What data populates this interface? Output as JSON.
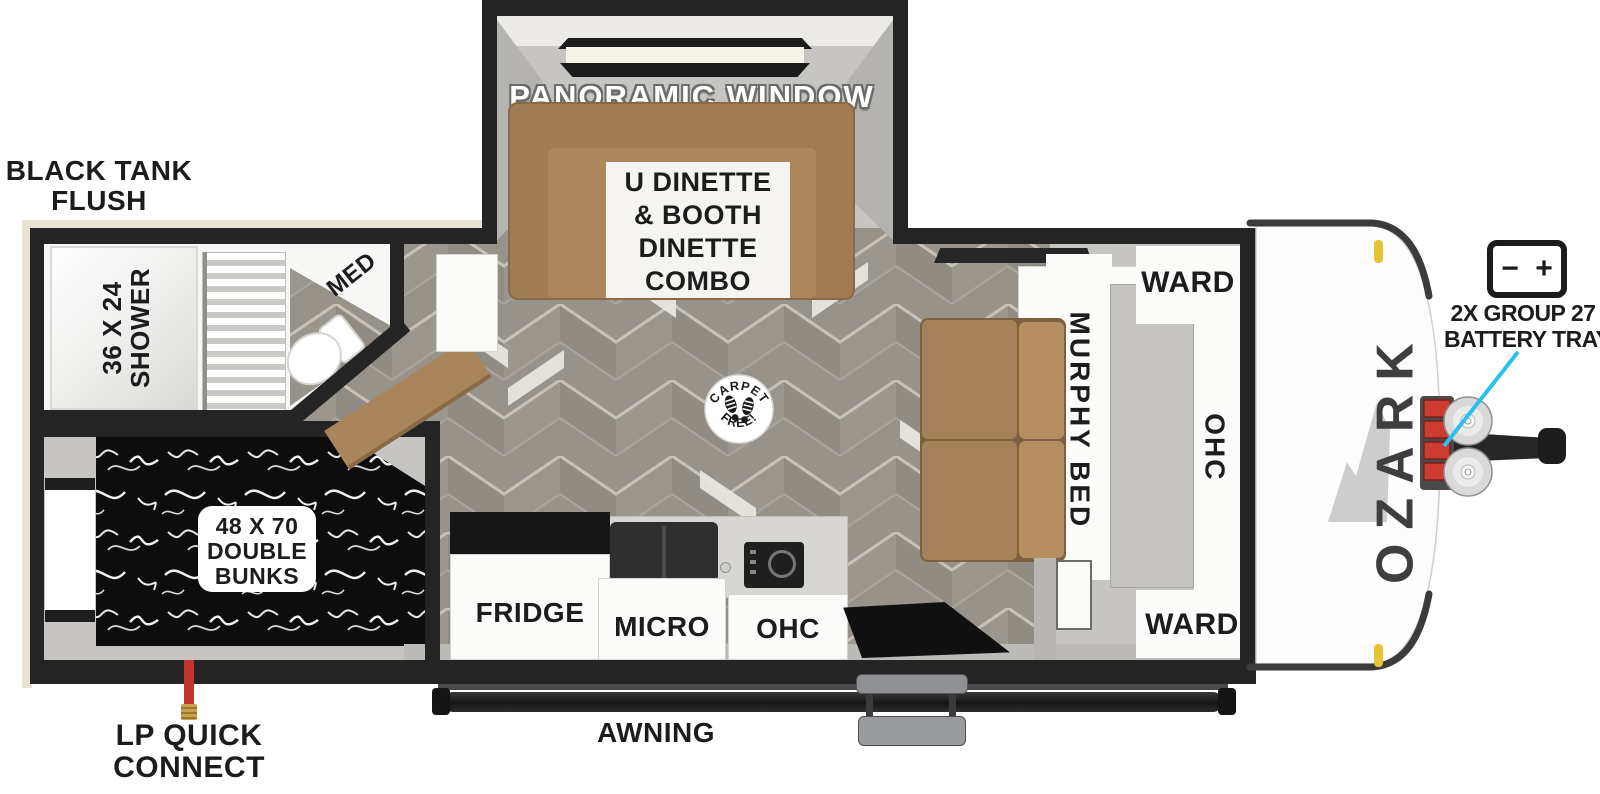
{
  "title": "Ozark travel trailer floorplan",
  "colors": {
    "wall": "#242424",
    "floor_base": "#97928a",
    "floor_light": "#9b968e",
    "floor_dark": "#908c84",
    "dinette_brown": "#a7835a",
    "bed_brown": "#a8835a",
    "bedding_black": "#0d0d0d",
    "callout_cyan": "#2ac1f2",
    "battery_red": "#cd3a30",
    "marker_yellow": "#e7c437",
    "brand_gray": "#3e3e3e",
    "label_black": "#1c1c1c"
  },
  "exterior": {
    "black_tank_line1": "BLACK TANK",
    "black_tank_line2": "FLUSH",
    "lp_line1": "LP QUICK",
    "lp_line2": "CONNECT",
    "awning": "AWNING",
    "brand": "OZARK",
    "battery_note_line1": "2X GROUP 27",
    "battery_note_line2": "BATTERY TRAY",
    "battery_minus": "−",
    "battery_plus": "+"
  },
  "slideout": {
    "window_label": "PANORAMIC WINDOW",
    "dinette_line1": "U DINETTE",
    "dinette_line2": "& BOOTH",
    "dinette_line3": "DINETTE",
    "dinette_line4": "COMBO"
  },
  "bathroom": {
    "shower_line1": "36 X 24",
    "shower_line2": "SHOWER",
    "med": "MED"
  },
  "bunkroom": {
    "bunks_line1": "48 X 70",
    "bunks_line2": "DOUBLE",
    "bunks_line3": "BUNKS"
  },
  "living": {
    "stamp_top": "CARPET",
    "stamp_bottom": "FREE!",
    "murphy_bed": "MURPHY BED",
    "ward_top": "WARD",
    "ohc": "OHC",
    "ward_bottom": "WARD"
  },
  "kitchen": {
    "fridge": "FRIDGE",
    "micro": "MICRO",
    "ohc": "OHC"
  }
}
